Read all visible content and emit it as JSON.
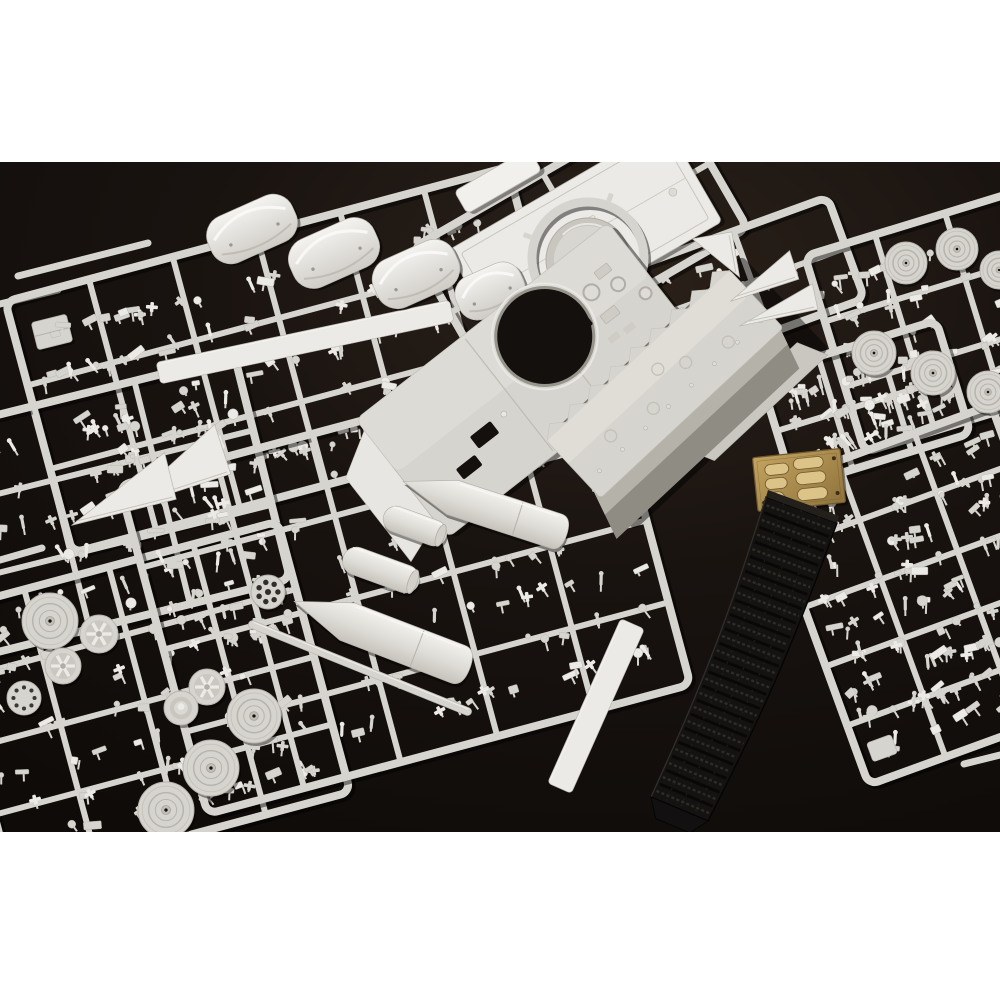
{
  "canvas": {
    "w": 1000,
    "h": 1000
  },
  "photo": {
    "y": 162,
    "h": 670
  },
  "bands": {
    "top": {
      "y": 0,
      "h": 162
    },
    "bottom": {
      "y": 832,
      "h": 168
    }
  },
  "palette": {
    "band": "#ffffff",
    "bg0": "#2b2119",
    "bg1": "#191310",
    "bg2": "#0e0b09",
    "plastic": "#d6d4ce",
    "plastic_light": "#eceae6",
    "plastic_dark": "#aaa79f",
    "plastic_deep": "#8e8b83",
    "shade": "#b5b2aa",
    "brass": "#ab8d4e",
    "brass_light": "#dcc488",
    "brass_dark": "#6f5930",
    "track": "#151312",
    "track_ridge": "#322f2a",
    "track_hi": "#3c3934",
    "hole": "#14100d"
  },
  "scene": {
    "items": [
      {
        "kind": "runners",
        "name": "stray-runners",
        "list": [
          [
            18,
            276,
            148,
            243,
            7
          ],
          [
            0,
            304,
            58,
            290,
            7
          ],
          [
            0,
            560,
            42,
            548,
            7
          ],
          [
            964,
            764,
            1000,
            755,
            7
          ]
        ]
      },
      {
        "kind": "boxes",
        "name": "left-edge-part",
        "list": [
          [
            52,
            332,
            36,
            28,
            -14
          ]
        ]
      },
      {
        "kind": "frame",
        "name": "sprue-left-main",
        "x": 290,
        "y": 360,
        "w": 520,
        "h": 260,
        "rot": -15,
        "cols": 6,
        "rows": 3,
        "seed": 11,
        "density": 115
      },
      {
        "kind": "frame",
        "name": "sprue-left-lower",
        "x": 112,
        "y": 505,
        "w": 310,
        "h": 230,
        "rot": -14,
        "cols": 3,
        "rows": 3,
        "seed": 22,
        "density": 70
      },
      {
        "kind": "frame",
        "name": "sprue-wheels-bottom-left",
        "x": 145,
        "y": 702,
        "w": 350,
        "h": 280,
        "rot": -15,
        "cols": 4,
        "rows": 4,
        "seed": 33,
        "density": 75
      },
      {
        "kind": "frame",
        "name": "sprue-top-deck",
        "x": 580,
        "y": 238,
        "w": 300,
        "h": 150,
        "rot": -30,
        "cols": 2,
        "rows": 2,
        "seed": 44,
        "density": 10
      },
      {
        "kind": "frame",
        "name": "sprue-triangle-parts",
        "x": 752,
        "y": 282,
        "w": 200,
        "h": 108,
        "rot": -20,
        "cols": 2,
        "rows": 2,
        "seed": 55,
        "density": 26
      },
      {
        "kind": "frame",
        "name": "sprue-wheels-top-right",
        "x": 940,
        "y": 322,
        "w": 220,
        "h": 205,
        "rot": -17,
        "cols": 3,
        "rows": 3,
        "seed": 66,
        "density": 48
      },
      {
        "kind": "frame",
        "name": "sprue-right-mid",
        "x": 865,
        "y": 404,
        "w": 185,
        "h": 118,
        "rot": -17,
        "cols": 3,
        "rows": 2,
        "seed": 77,
        "density": 55
      },
      {
        "kind": "frame",
        "name": "sprue-center-tanks",
        "x": 405,
        "y": 585,
        "w": 500,
        "h": 340,
        "rot": -15,
        "cols": 5,
        "rows": 4,
        "seed": 88,
        "density": 95
      },
      {
        "kind": "frame",
        "name": "sprue-right-tall",
        "x": 930,
        "y": 595,
        "w": 245,
        "h": 315,
        "rot": -20,
        "cols": 3,
        "rows": 5,
        "seed": 99,
        "density": 125
      },
      {
        "kind": "bars",
        "name": "flat-strip-parts",
        "list": [
          [
            305,
            342,
            300,
            22,
            -12,
            1
          ],
          [
            360,
            668,
            240,
            8,
            22,
            0
          ],
          [
            596,
            706,
            180,
            26,
            -66,
            1
          ]
        ]
      },
      {
        "kind": "plate",
        "name": "engine-deck-plate",
        "x": 585,
        "y": 236,
        "w": 252,
        "h": 112,
        "rot": -30
      },
      {
        "kind": "plate",
        "name": "deck-lip",
        "x": 498,
        "y": 181,
        "w": 86,
        "h": 26,
        "rot": -30,
        "light": true
      },
      {
        "kind": "fenders",
        "name": "fender-pieces",
        "list": [
          [
            252,
            229,
            92,
            50,
            -24
          ],
          [
            334,
            253,
            92,
            52,
            -24
          ],
          [
            416,
            274,
            88,
            52,
            -24
          ],
          [
            490,
            291,
            70,
            46,
            -24
          ]
        ]
      },
      {
        "kind": "ring_disc",
        "name": "turret-ring",
        "x": 588,
        "y": 258,
        "rOuter": 56,
        "ringW": 9,
        "rDisc": 42
      },
      {
        "kind": "hull_top",
        "name": "upper-hull",
        "x": 528,
        "y": 380,
        "len": 320,
        "wid": 150,
        "rot": -38,
        "hole": {
          "lx": 40,
          "ly": -24,
          "r": 49
        }
      },
      {
        "kind": "hull_tub",
        "name": "lower-hull-tub",
        "x": 676,
        "y": 396,
        "len": 250,
        "wid": 128,
        "rot": -43
      },
      {
        "kind": "wedges",
        "name": "wedge-plates",
        "list": [
          [
            168,
            467,
            115,
            52,
            -18
          ],
          [
            118,
            489,
            108,
            48,
            -14
          ],
          [
            716,
            258,
            46,
            40,
            -100
          ],
          [
            760,
            276,
            72,
            30,
            -18
          ],
          [
            776,
            305,
            80,
            26,
            -12
          ]
        ]
      },
      {
        "kind": "wheels",
        "name": "road-wheels",
        "list": [
          [
            50,
            621,
            28,
            "disc"
          ],
          [
            99,
            634,
            19,
            "spoke"
          ],
          [
            63,
            666,
            18,
            "spoke"
          ],
          [
            24,
            698,
            17,
            "sprocket"
          ],
          [
            207,
            687,
            18,
            "spoke"
          ],
          [
            181,
            708,
            17,
            "cone"
          ],
          [
            254,
            716,
            27,
            "disc"
          ],
          [
            211,
            768,
            28,
            "disc"
          ],
          [
            166,
            810,
            28,
            "disc"
          ],
          [
            906,
            263,
            21,
            "disc"
          ],
          [
            957,
            249,
            21,
            "disc"
          ],
          [
            999,
            270,
            19,
            "disc"
          ],
          [
            874,
            353,
            22,
            "disc"
          ],
          [
            933,
            373,
            22,
            "disc"
          ],
          [
            988,
            392,
            21,
            "disc"
          ]
        ]
      },
      {
        "kind": "perf_disc",
        "name": "perforated-disc",
        "x": 268,
        "y": 592,
        "r": 17
      },
      {
        "kind": "cylinders",
        "name": "muffler-cylinders",
        "list": [
          [
            415,
            526,
            66,
            26,
            20
          ],
          [
            381,
            570,
            80,
            28,
            20
          ]
        ]
      },
      {
        "kind": "bullets",
        "name": "external-fuel-tanks",
        "list": [
          [
            485,
            508,
            172,
            36,
            18
          ],
          [
            382,
            635,
            188,
            40,
            21
          ]
        ]
      },
      {
        "kind": "pe_fret",
        "name": "photo-etch-fret",
        "x": 799,
        "y": 480,
        "w": 88,
        "h": 54,
        "rot": -6
      },
      {
        "kind": "track",
        "name": "vinyl-track",
        "p0": [
          766,
          497
        ],
        "p1": [
          837,
          523
        ],
        "p2": [
          708,
          821
        ],
        "p3": [
          651,
          797
        ],
        "bulge": 6,
        "links": 42
      }
    ]
  }
}
